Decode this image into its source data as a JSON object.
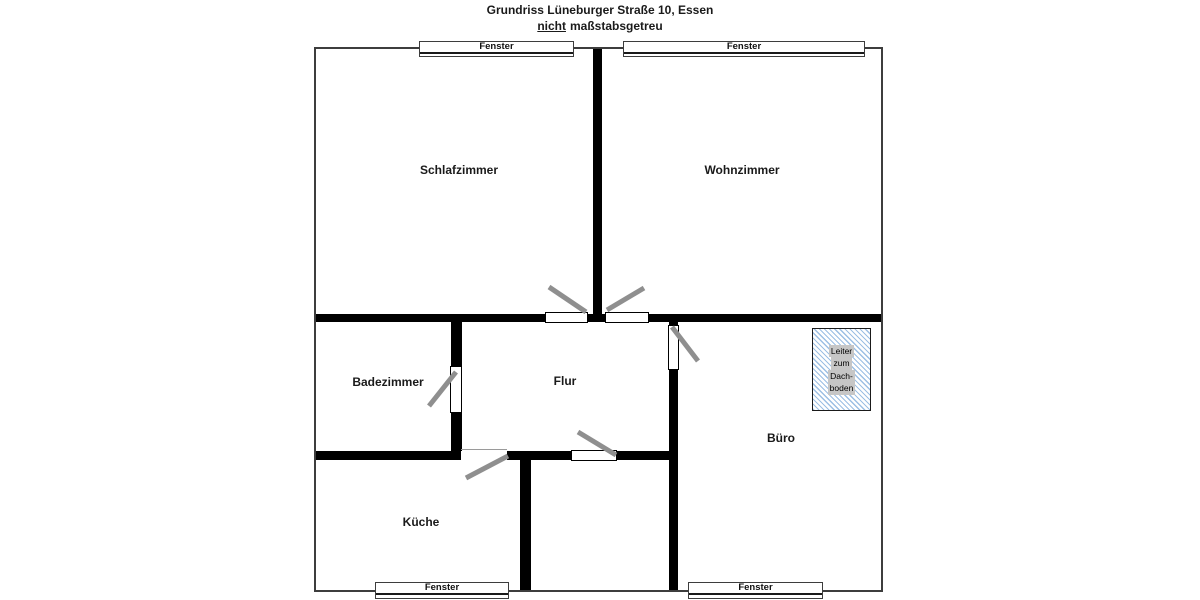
{
  "title": {
    "line1": "Grundriss Lüneburger Straße 10, Essen",
    "subtitle_emphasis": "nicht",
    "subtitle_rest": "maßstabsgetreu"
  },
  "rooms": {
    "schlafzimmer": "Schlafzimmer",
    "wohnzimmer": "Wohnzimmer",
    "badezimmer": "Badezimmer",
    "flur": "Flur",
    "buero": "Büro",
    "kueche": "Küche"
  },
  "windows": {
    "top_left": "Fenster",
    "top_right": "Fenster",
    "bottom_left": "Fenster",
    "bottom_right": "Fenster"
  },
  "attic_ladder": {
    "line1": "Leiter",
    "line2": "zum",
    "line3": "Dach-",
    "line4": "boden"
  },
  "colors": {
    "wall": "#000000",
    "outer_wall": "#3d3d3d",
    "door_swing": "#8f8f8f",
    "hatch_blue": "#9cbfe4",
    "ladder_label_bg": "#c6c6c6"
  }
}
